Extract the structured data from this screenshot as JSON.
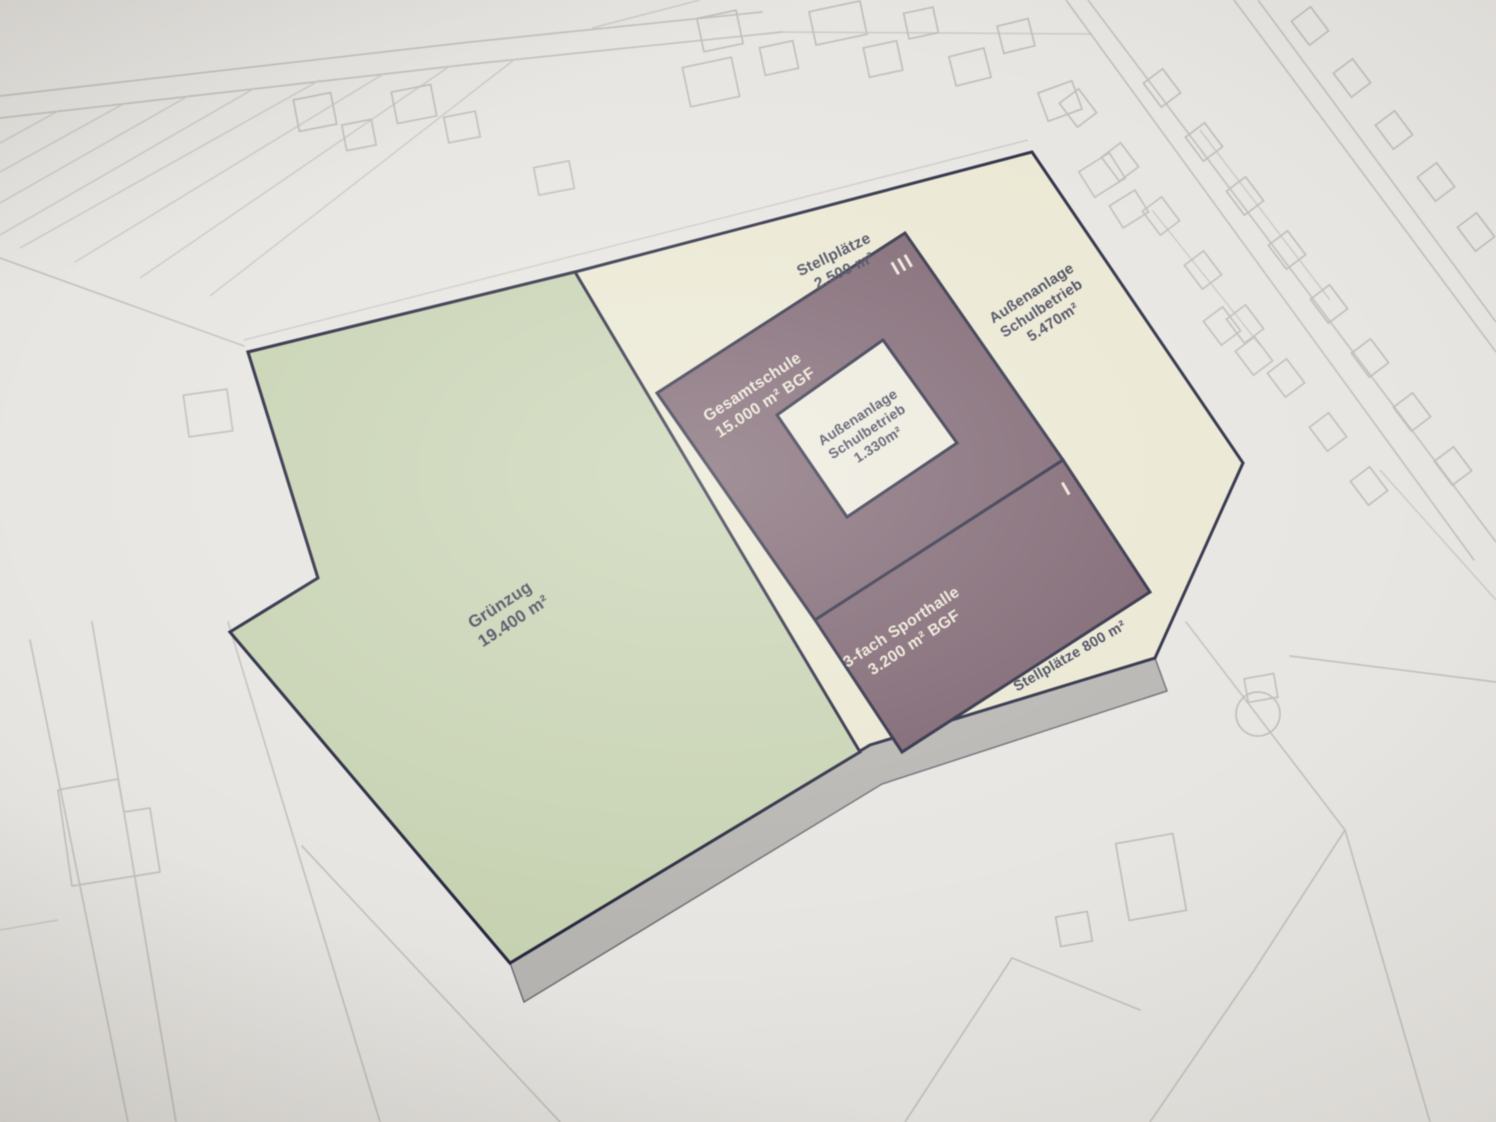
{
  "site_plan": {
    "colors": {
      "map_background": "#e7e5e1",
      "map_lines": "#c3c1bc",
      "boundary": "#262840",
      "green_area": "#c7d2b2",
      "paved_area": "#eae7d2",
      "building": "#7a616e",
      "courtyard": "#ece9dc",
      "shadow_side": "#b6b4b0"
    },
    "zones": {
      "gruenzug": {
        "lines": [
          "Grünzug",
          "19.400 m²"
        ]
      },
      "stellplaetze_nord": {
        "lines": [
          "Stellplätze",
          "2.500 m²"
        ]
      },
      "gesamtschule": {
        "lines": [
          "Gesamtschule",
          "15.000 m² BGF"
        ],
        "storey_marker": "III"
      },
      "innenhof": {
        "lines": [
          "Außenanlage",
          "Schulbetrieb",
          "1.330m²"
        ]
      },
      "aussenanlage_ost": {
        "lines": [
          "Außenanlage",
          "Schulbetrieb",
          "5.470m²"
        ]
      },
      "sporthalle": {
        "lines": [
          "3-fach Sporthalle",
          "3.200 m² BGF"
        ],
        "storey_marker": "I"
      },
      "stellplaetze_sued": {
        "lines": [
          "Stellplätze 800 m²"
        ]
      }
    }
  }
}
